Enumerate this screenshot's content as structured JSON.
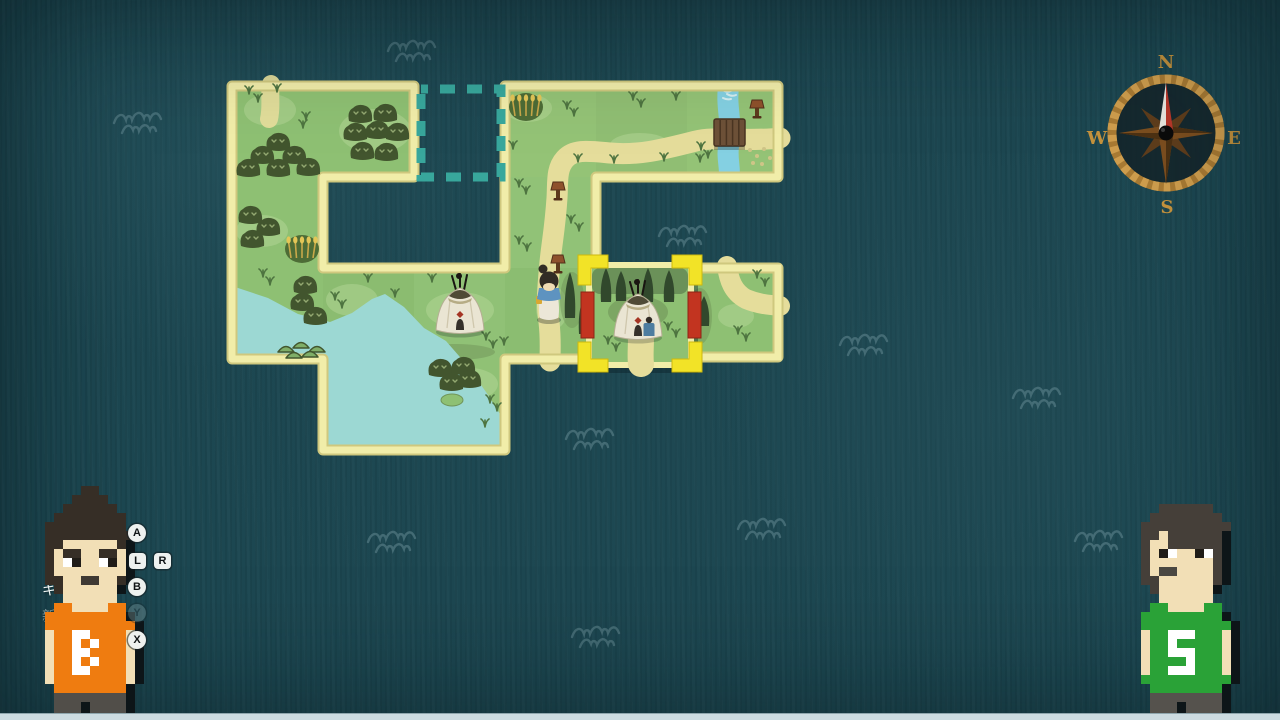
{
  "colors": {
    "ocean": "#1c4751",
    "wave": "#5d838c",
    "grass": "#8ec073",
    "grass_light": "#b9d99b",
    "grass_dark": "#6f9458",
    "border_light": "#f1eda9",
    "border_dark": "#cfc87e",
    "path": "#e5dd9b",
    "lake": "#9cd8d3",
    "river": "#84d0e2",
    "bush": "#42552e",
    "bush_mark": "#93a871",
    "tree": "#31482c",
    "mound": "#7fae68",
    "mound_line": "#42572f",
    "wheat_bg": "#4d6c36",
    "wheat": "#e3c657",
    "sign_cap": "#8e512c",
    "sign_post": "#5e3a1d",
    "teepee_body": "#eae5d3",
    "teepee_top": "#4f4a36",
    "teepee_red": "#a53524",
    "slot": "#38a79c",
    "bracket": "#f2e327",
    "bar_red": "#c23420",
    "girl_hair": "#322c25",
    "girl_scarf": "#5e93c0",
    "girl_dress": "#ece7d8",
    "skin": "#f0dcb4",
    "strip": "#ccdbe0"
  },
  "ocean": {
    "waves": [
      [
        138,
        127
      ],
      [
        412,
        55
      ],
      [
        683,
        240
      ],
      [
        864,
        349
      ],
      [
        1037,
        402
      ],
      [
        590,
        443
      ],
      [
        392,
        546
      ],
      [
        762,
        533
      ],
      [
        596,
        641
      ],
      [
        1099,
        545
      ]
    ]
  },
  "map": {
    "tile_grid": [
      "TTOTTT",
      "T..T..",
      "TTTTFT",
      ".TT..."
    ],
    "origin": {
      "x": 232,
      "y": 86
    },
    "tile_size": 91,
    "landmass": "M232,86 L414,86 L414,177 L323,177 L323,268 L505,268 L505,86 L778,86 L778,177 L596,177 L596,359 L505,359 L505,450 L323,450 L323,359 L232,359 Z",
    "island": {
      "x": 687,
      "y": 268,
      "w": 91,
      "h": 89,
      "path": "M727,266 C729,280 733,292 746,299 C758,304 769,305 780,306",
      "blob": [
        700,
        316,
        12,
        28
      ]
    },
    "empty_slot": {
      "x": 421,
      "y": 89,
      "w": 80,
      "h": 88
    },
    "lake_points": "232,286 268,298 298,314 330,322 352,313 372,299 385,294 404,307 424,328 446,341 466,364 486,392 500,414 505,427 505,446 327,446 327,362 232,362",
    "islet": [
      452,
      400,
      11,
      6
    ],
    "paths": {
      "stub_top": "M271,84 C269,96 272,106 269,119",
      "main": "M780,138 C745,142 715,136 696,141 C668,148 640,156 610,153 C588,151 574,149 565,159 C556,169 558,182 557,198 C555,228 552,242 550,262 C548,285 546,302 549,322 C551,340 550,350 550,361"
    },
    "river": {
      "d": "M729,84 C725,105 733,125 729,143 C726,158 731,168 729,179",
      "foam": [
        "M721,89 q5,4 10,2",
        "M727,94 q5,3 9,1",
        "M723,98 q4,2 8,1"
      ]
    },
    "bridge": {
      "x": 714,
      "y": 119,
      "w": 31,
      "h": 27
    },
    "speckles": [
      [
        750,
        150
      ],
      [
        757,
        156
      ],
      [
        764,
        149
      ],
      [
        770,
        158
      ],
      [
        762,
        164
      ],
      [
        753,
        163
      ]
    ],
    "light_patches": [
      [
        270,
        110,
        26,
        16
      ],
      [
        375,
        131,
        36,
        22
      ],
      [
        262,
        231,
        26,
        16
      ],
      [
        352,
        300,
        26,
        16
      ],
      [
        460,
        310,
        34,
        18
      ],
      [
        528,
        108,
        24,
        14
      ],
      [
        640,
        145,
        30,
        12
      ],
      [
        470,
        384,
        28,
        16
      ],
      [
        736,
        316,
        18,
        12
      ],
      [
        552,
        308,
        16,
        22
      ]
    ],
    "dark_patches": [
      [
        455,
        352,
        40,
        8
      ],
      [
        572,
        300,
        12,
        28
      ]
    ],
    "bushes": [
      [
        278,
        141
      ],
      [
        262,
        154
      ],
      [
        294,
        154
      ],
      [
        248,
        167
      ],
      [
        278,
        167
      ],
      [
        308,
        166
      ],
      [
        360,
        113
      ],
      [
        385,
        112
      ],
      [
        355,
        131
      ],
      [
        377,
        129
      ],
      [
        397,
        131
      ],
      [
        362,
        150
      ],
      [
        386,
        151
      ],
      [
        250,
        214
      ],
      [
        268,
        226
      ],
      [
        252,
        238
      ],
      [
        305,
        284
      ],
      [
        302,
        301
      ],
      [
        315,
        315
      ],
      [
        440,
        367
      ],
      [
        463,
        365
      ],
      [
        451,
        381
      ],
      [
        469,
        378
      ]
    ],
    "mounds": [
      [
        286,
        352
      ],
      [
        301,
        348
      ],
      [
        317,
        352
      ],
      [
        294,
        358
      ],
      [
        310,
        357
      ]
    ],
    "tufts": [
      [
        249,
        94
      ],
      [
        258,
        102
      ],
      [
        277,
        92
      ],
      [
        306,
        120
      ],
      [
        303,
        128
      ],
      [
        263,
        277
      ],
      [
        270,
        285
      ],
      [
        335,
        300
      ],
      [
        342,
        308
      ],
      [
        368,
        282
      ],
      [
        395,
        297
      ],
      [
        432,
        282
      ],
      [
        486,
        340
      ],
      [
        493,
        348
      ],
      [
        504,
        345
      ],
      [
        567,
        109
      ],
      [
        574,
        116
      ],
      [
        633,
        100
      ],
      [
        641,
        107
      ],
      [
        676,
        100
      ],
      [
        513,
        149
      ],
      [
        578,
        162
      ],
      [
        614,
        163
      ],
      [
        664,
        161
      ],
      [
        700,
        162
      ],
      [
        701,
        150
      ],
      [
        708,
        158
      ],
      [
        519,
        187
      ],
      [
        526,
        194
      ],
      [
        571,
        223
      ],
      [
        579,
        231
      ],
      [
        519,
        244
      ],
      [
        527,
        251
      ],
      [
        757,
        278
      ],
      [
        765,
        286
      ],
      [
        738,
        334
      ],
      [
        746,
        341
      ],
      [
        490,
        403
      ],
      [
        497,
        411
      ],
      [
        485,
        427
      ]
    ],
    "trees": [
      [
        570,
        272,
        46
      ],
      [
        584,
        296,
        38
      ],
      [
        704,
        296,
        30
      ]
    ],
    "signposts": [
      [
        558,
        182
      ],
      [
        558,
        255
      ],
      [
        757,
        100
      ]
    ],
    "wheat": [
      [
        526,
        107
      ],
      [
        302,
        249
      ]
    ],
    "teepee": {
      "x": 460,
      "y": 306
    },
    "player": {
      "x": 549,
      "y": 282
    },
    "seams": [
      [
        596,
        86,
        "#000000",
        0.025
      ],
      [
        505,
        177,
        "#ffffff",
        0.03
      ],
      [
        323,
        268,
        "#000000",
        0.02
      ],
      [
        414,
        268,
        "#ffffff",
        0.025
      ],
      [
        414,
        359,
        "#ffffff",
        0.02
      ],
      [
        505,
        268,
        "#000000",
        0.015
      ]
    ],
    "arm_tint": {
      "x": 505,
      "y": 86,
      "w": 273,
      "h": 91
    }
  },
  "selected_tile": {
    "x": 589,
    "y": 265,
    "w": 102,
    "h": 100,
    "shadow_offset": [
      7,
      8
    ],
    "bars": [
      [
        581,
        292
      ],
      [
        688,
        292
      ]
    ],
    "bracket": {
      "x": 578,
      "y": 255,
      "w": 124,
      "h": 117,
      "t": 13,
      "a": 30
    },
    "band": {
      "x": 592,
      "y": 268,
      "w": 96,
      "h": 26
    },
    "blob": [
      638,
      312,
      30,
      16
    ],
    "trees": [
      [
        606,
        268,
        34
      ],
      [
        621,
        271,
        30
      ],
      [
        648,
        268,
        34
      ],
      [
        669,
        270,
        32
      ]
    ],
    "teepee": {
      "x": 638,
      "y": 312
    },
    "path_stub": "M641,336 C641,348 640,356 641,364",
    "tufts": [
      [
        608,
        344
      ],
      [
        616,
        351
      ],
      [
        668,
        330
      ],
      [
        676,
        337
      ]
    ]
  },
  "compass": {
    "n": "N",
    "e": "E",
    "s": "S",
    "w": "W"
  },
  "hud": {
    "prompts": [
      {
        "key": "A",
        "shape": "circle",
        "x": 128,
        "y": 524,
        "dim": false
      },
      {
        "key": "L",
        "shape": "square",
        "x": 129,
        "y": 553,
        "dim": false
      },
      {
        "key": "R",
        "shape": "square",
        "x": 154,
        "y": 553,
        "dim": false
      },
      {
        "key": "B",
        "shape": "circle",
        "x": 128,
        "y": 578,
        "dim": false
      },
      {
        "key": "Y",
        "shape": "circle",
        "x": 128,
        "y": 604,
        "dim": true
      },
      {
        "key": "X",
        "shape": "circle",
        "x": 128,
        "y": 631,
        "dim": false
      }
    ],
    "menu_fragments": [
      {
        "text": "キ",
        "x": 42,
        "y": 580,
        "dim": false
      },
      {
        "text": "新",
        "x": 42,
        "y": 606,
        "dim": true
      }
    ]
  },
  "characters": {
    "left": {
      "shirt_letter": "B",
      "x": 36,
      "y": 486,
      "px": 9,
      "palette": {
        "H": "#362e26",
        "S": "#f2dfb6",
        "W": "#ffffff",
        "P": "#201c17",
        "O": "#ef7c10",
        "A": "#ffffff",
        "D": "#514e49",
        "K": "#0d1518",
        "M": "#3f3933"
      },
      "grid": [
        ".....HH......",
        "....HHHH.....",
        "...HHHHHH....",
        "..HHHHHHHH...",
        ".HHHHHHHHH...",
        ".HHHHHHHHHH..",
        ".HHSSSSSSHK..",
        ".HSHHSSHHSK..",
        ".HSWPSSWPSK..",
        ".HSSSSSSSSK..",
        ".HHSSMMSSHK..",
        "..HSSSSSSK...",
        "...SSSSSS....",
        "..OOSSSSOO...",
        ".OOOOOOOOOK..",
        ".OOOOOOOOOOK.",
        ".SOOAAOOOOSK.",
        ".SOOAOAOOOSK.",
        ".SOOAAOOOOSK.",
        ".SOOAOAOOOSK.",
        ".SOOAAOOOOSK.",
        ".SOOOOOOOOSK.",
        "..OOOOOOOOK..",
        "..DDDDDDDDK..",
        "..DDDKDDDDK..",
        "..DDDKDDDDK.."
      ]
    },
    "right": {
      "shirt_letter": "S",
      "x": 1132,
      "y": 504,
      "px": 9,
      "palette": {
        "H": "#453f39",
        "S": "#f2dfb6",
        "W": "#ffffff",
        "P": "#201c17",
        "G": "#2aa237",
        "A": "#ffffff",
        "D": "#55524d",
        "K": "#0d1518",
        "M": "#4a4741"
      },
      "grid": [
        "...HHHHHH....",
        "..HHHHHHHH...",
        ".HHHHHHHHHH..",
        ".HHSHHHHHHK..",
        ".HSSHHHHHHK..",
        ".HSPWSSPWHK..",
        ".HSSSSSSSHK..",
        ".HSMMSSSSHK..",
        ".HHSSSSSSHK..",
        "..HSSSSSSK...",
        "...SSSSSS....",
        "..GGSSSSGG...",
        ".GGGGGGGGGK..",
        ".GGGGGGGGGGK.",
        ".SGGAAAGGGSK.",
        ".SGGAGGGGGSK.",
        ".SGGAAAGGGSK.",
        ".SGGGGAGGGSK.",
        ".SGGAAAGGGSK.",
        ".GGGGGGGGGGK.",
        "..GGGGGGGGK..",
        "..DDDDDDDDK..",
        "..DDDKDDDDK..",
        "..DDDKDDDDK.."
      ]
    }
  }
}
